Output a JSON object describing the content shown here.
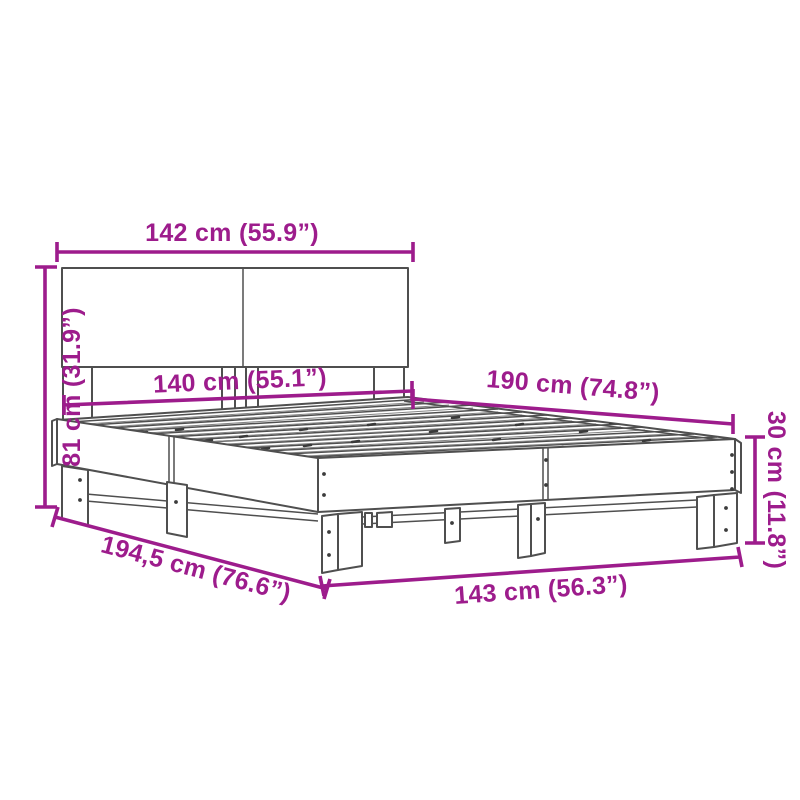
{
  "figure": {
    "name": "bed-frame-dimension-diagram",
    "background": "#ffffff",
    "line_color": "#4f4f4f",
    "accent_color": "#9d1c8c"
  },
  "dimensions": {
    "headboard_width": "142 cm (55.9”)",
    "headboard_height": "81 cm (31.9”)",
    "slat_area_width": "140 cm (55.1”)",
    "slat_area_length": "190 cm (74.8”)",
    "frame_height": "30 cm (11.8”)",
    "total_length": "194,5 cm (76.6”)",
    "total_width": "143 cm (56.3”)"
  }
}
